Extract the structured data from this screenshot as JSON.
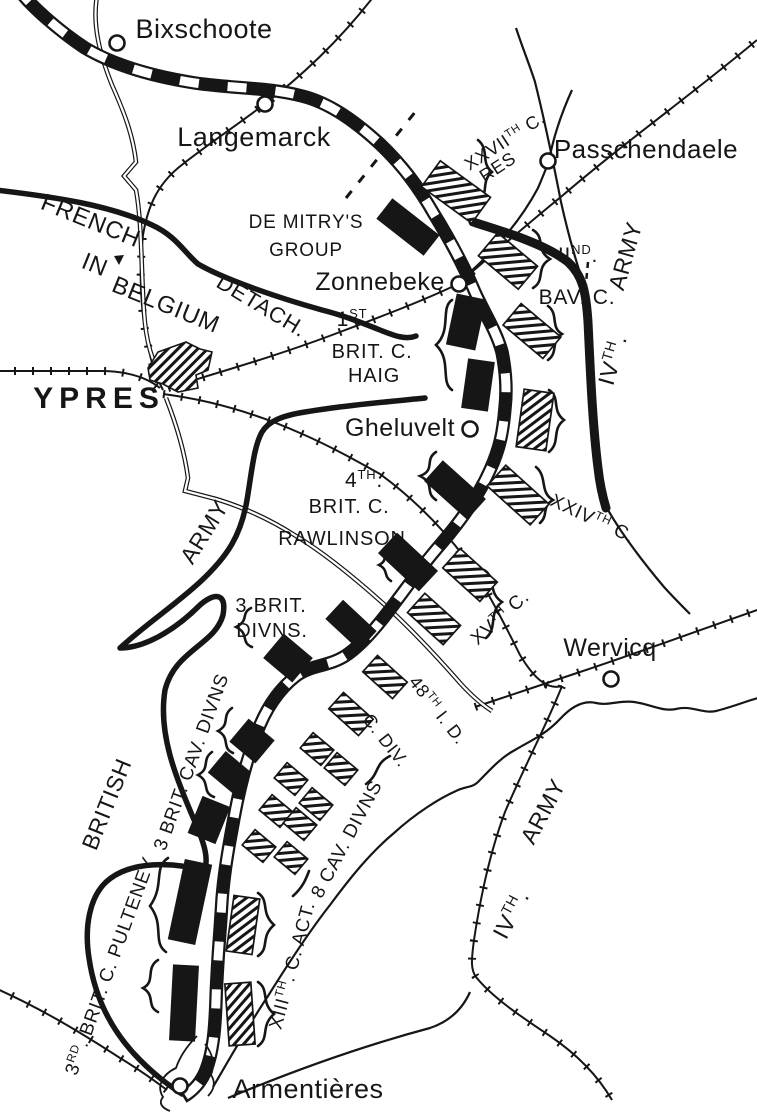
{
  "map_title": "First Battle of Ypres front map",
  "colors": {
    "ink": "#161616",
    "paper": "#ffffff"
  },
  "towns": [
    {
      "id": "bixschoote",
      "label": "Bixschoote",
      "circle": [
        117,
        43
      ],
      "label_pos": [
        204,
        38
      ],
      "size": 27
    },
    {
      "id": "langemarck",
      "label": "Langemarck",
      "circle": [
        265,
        104
      ],
      "label_pos": [
        254,
        146
      ],
      "size": 27
    },
    {
      "id": "passchendaele",
      "label": "Passchendaele",
      "circle": [
        548,
        161
      ],
      "label_pos": [
        646,
        158
      ],
      "size": 26
    },
    {
      "id": "zonnebeke",
      "label": "Zonnebeke",
      "circle": [
        459,
        284
      ],
      "label_pos": [
        380,
        290
      ],
      "size": 25
    },
    {
      "id": "gheluvelt",
      "label": "Gheluvelt",
      "circle": [
        470,
        429
      ],
      "label_pos": [
        400,
        436
      ],
      "size": 25
    },
    {
      "id": "wervicq",
      "label": "Wervicq",
      "circle": [
        611,
        679
      ],
      "label_pos": [
        610,
        656
      ],
      "size": 25
    },
    {
      "id": "armentieres",
      "label": "Armentières",
      "circle": [
        180,
        1086
      ],
      "label_pos": [
        308,
        1098
      ],
      "size": 27
    }
  ],
  "labels": [
    {
      "id": "ypres",
      "parts": [
        {
          "t": "YPRES"
        }
      ],
      "x": 99,
      "y": 408,
      "rot": 0,
      "size": 30,
      "style": "big"
    },
    {
      "id": "french",
      "parts": [
        {
          "t": "FRENCH"
        }
      ],
      "x": 88,
      "y": 228,
      "rot": 22,
      "size": 24
    },
    {
      "id": "in",
      "parts": [
        {
          "t": "IN"
        }
      ],
      "x": 92,
      "y": 272,
      "rot": 22,
      "size": 24
    },
    {
      "id": "belgium",
      "parts": [
        {
          "t": "BELGIUM"
        }
      ],
      "x": 163,
      "y": 312,
      "rot": 22,
      "size": 24
    },
    {
      "id": "detach",
      "parts": [
        {
          "t": "DETACH."
        }
      ],
      "x": 258,
      "y": 312,
      "rot": 31,
      "size": 22
    },
    {
      "id": "de-mitrys",
      "parts": [
        {
          "t": "DE MITRY'S"
        }
      ],
      "x": 306,
      "y": 228,
      "rot": 0,
      "size": 19
    },
    {
      "id": "group",
      "parts": [
        {
          "t": "GROUP"
        }
      ],
      "x": 306,
      "y": 256,
      "rot": 0,
      "size": 19
    },
    {
      "id": "xxvii-c",
      "parts": [
        {
          "t": "XXVII"
        },
        {
          "t": "TH",
          "sup": true
        },
        {
          "t": " C."
        }
      ],
      "x": 508,
      "y": 146,
      "rot": -33,
      "size": 18
    },
    {
      "id": "xxvii-res",
      "parts": [
        {
          "t": "RES"
        }
      ],
      "x": 501,
      "y": 172,
      "rot": -33,
      "size": 18
    },
    {
      "id": "iind",
      "parts": [
        {
          "t": "II"
        },
        {
          "t": "ND",
          "sup": true
        },
        {
          "t": "."
        }
      ],
      "x": 578,
      "y": 262,
      "rot": 0,
      "size": 21
    },
    {
      "id": "bav-c",
      "parts": [
        {
          "t": "BAV. C."
        }
      ],
      "x": 577,
      "y": 304,
      "rot": 0,
      "size": 21
    },
    {
      "id": "ivth-r",
      "parts": [
        {
          "t": "IV"
        },
        {
          "t": "TH",
          "sup": true
        },
        {
          "t": "."
        }
      ],
      "x": 620,
      "y": 362,
      "rot": -74,
      "size": 23
    },
    {
      "id": "army-r",
      "parts": [
        {
          "t": "ARMY"
        }
      ],
      "x": 633,
      "y": 258,
      "rot": -74,
      "size": 23
    },
    {
      "id": "first",
      "parts": [
        {
          "t": "1"
        },
        {
          "t": "ST",
          "sup": true
        }
      ],
      "x": 352,
      "y": 326,
      "rot": 0,
      "size": 21
    },
    {
      "id": "brit-c-1",
      "parts": [
        {
          "t": "BRIT. C."
        }
      ],
      "x": 372,
      "y": 358,
      "rot": 0,
      "size": 20
    },
    {
      "id": "haig",
      "parts": [
        {
          "t": "HAIG"
        }
      ],
      "x": 374,
      "y": 382,
      "rot": 0,
      "size": 20
    },
    {
      "id": "fourth",
      "parts": [
        {
          "t": "4"
        },
        {
          "t": "TH",
          "sup": true
        },
        {
          "t": "."
        }
      ],
      "x": 364,
      "y": 487,
      "rot": 0,
      "size": 21
    },
    {
      "id": "brit-c-4",
      "parts": [
        {
          "t": "BRIT. C."
        }
      ],
      "x": 349,
      "y": 513,
      "rot": 0,
      "size": 20
    },
    {
      "id": "rawlinson",
      "parts": [
        {
          "t": "RAWLINSON"
        }
      ],
      "x": 342,
      "y": 545,
      "rot": 0,
      "size": 20
    },
    {
      "id": "xxiv-c",
      "parts": [
        {
          "t": "XXIV"
        },
        {
          "t": "TH",
          "sup": true
        },
        {
          "t": " C."
        }
      ],
      "x": 590,
      "y": 524,
      "rot": 25,
      "size": 19
    },
    {
      "id": "xv-c",
      "parts": [
        {
          "t": "XV"
        },
        {
          "t": "TH",
          "sup": true
        },
        {
          "t": " C."
        }
      ],
      "x": 504,
      "y": 622,
      "rot": -42,
      "size": 19
    },
    {
      "id": "brit-3",
      "parts": [
        {
          "t": "3 BRIT."
        }
      ],
      "x": 271,
      "y": 612,
      "rot": 0,
      "size": 20
    },
    {
      "id": "divns-3",
      "parts": [
        {
          "t": "DIVNS."
        }
      ],
      "x": 272,
      "y": 637,
      "rot": 0,
      "size": 20
    },
    {
      "id": "forty8-id",
      "parts": [
        {
          "t": "48"
        },
        {
          "t": "TH",
          "sup": true
        },
        {
          "t": " I. D."
        }
      ],
      "x": 433,
      "y": 714,
      "rot": 52,
      "size": 18
    },
    {
      "id": "c-div",
      "parts": [
        {
          "t": "C. DIV."
        }
      ],
      "x": 381,
      "y": 744,
      "rot": 52,
      "size": 18
    },
    {
      "id": "army-l",
      "parts": [
        {
          "t": "ARMY"
        }
      ],
      "x": 211,
      "y": 536,
      "rot": -58,
      "size": 23
    },
    {
      "id": "british",
      "parts": [
        {
          "t": "BRITISH"
        }
      ],
      "x": 114,
      "y": 807,
      "rot": -68,
      "size": 23
    },
    {
      "id": "cav-3",
      "parts": [
        {
          "t": "3 BRIT. CAV. DIVNS"
        }
      ],
      "x": 197,
      "y": 764,
      "rot": -70,
      "size": 19
    },
    {
      "id": "cav-8",
      "parts": [
        {
          "t": "8 CAV. DIVNS"
        }
      ],
      "x": 352,
      "y": 842,
      "rot": -62,
      "size": 19
    },
    {
      "id": "pulteney",
      "parts": [
        {
          "t": "3"
        },
        {
          "t": "RD",
          "sup": true
        },
        {
          "t": ". BRIT. C. PULTENEY"
        }
      ],
      "x": 116,
      "y": 968,
      "rot": -70,
      "size": 19
    },
    {
      "id": "xiii-c",
      "parts": [
        {
          "t": "XIII"
        },
        {
          "t": "TH",
          "sup": true
        },
        {
          "t": ". C. ACT."
        }
      ],
      "x": 298,
      "y": 967,
      "rot": -75,
      "size": 19
    },
    {
      "id": "ivth-b",
      "parts": [
        {
          "t": "IV"
        },
        {
          "t": "TH",
          "sup": true
        },
        {
          "t": "."
        }
      ],
      "x": 518,
      "y": 918,
      "rot": -62,
      "size": 23
    },
    {
      "id": "army-b",
      "parts": [
        {
          "t": "ARMY"
        }
      ],
      "x": 550,
      "y": 815,
      "rot": -62,
      "size": 23
    }
  ],
  "units": {
    "allied_solid": [
      [
        408,
        227,
        60,
        26,
        38
      ],
      [
        466,
        322,
        30,
        52,
        12
      ],
      [
        478,
        385,
        27,
        50,
        8
      ],
      [
        455,
        490,
        58,
        28,
        42
      ],
      [
        408,
        562,
        56,
        28,
        43
      ],
      [
        351,
        625,
        46,
        26,
        43
      ],
      [
        288,
        658,
        38,
        32,
        40
      ],
      [
        252,
        741,
        34,
        30,
        40
      ],
      [
        229,
        772,
        32,
        28,
        40
      ],
      [
        209,
        820,
        30,
        40,
        22
      ],
      [
        190,
        902,
        28,
        82,
        12
      ],
      [
        184,
        1003,
        26,
        76,
        3
      ]
    ],
    "german_hatched": [
      [
        456,
        192,
        62,
        32,
        36
      ],
      [
        508,
        261,
        52,
        30,
        40
      ],
      [
        532,
        331,
        52,
        28,
        40
      ],
      [
        535,
        420,
        30,
        58,
        8
      ],
      [
        518,
        495,
        58,
        28,
        42
      ],
      [
        470,
        575,
        50,
        26,
        42
      ],
      [
        434,
        619,
        48,
        26,
        42
      ],
      [
        385,
        677,
        40,
        22,
        42
      ],
      [
        351,
        714,
        40,
        22,
        42
      ],
      [
        317,
        749,
        27,
        20,
        40
      ],
      [
        341,
        769,
        27,
        20,
        40
      ],
      [
        291,
        779,
        27,
        20,
        40
      ],
      [
        316,
        804,
        27,
        20,
        40
      ],
      [
        276,
        811,
        27,
        20,
        40
      ],
      [
        300,
        824,
        27,
        20,
        40
      ],
      [
        259,
        846,
        27,
        20,
        40
      ],
      [
        291,
        858,
        27,
        20,
        40
      ],
      [
        243,
        925,
        26,
        56,
        8
      ],
      [
        240,
        1014,
        26,
        62,
        -4
      ]
    ]
  }
}
